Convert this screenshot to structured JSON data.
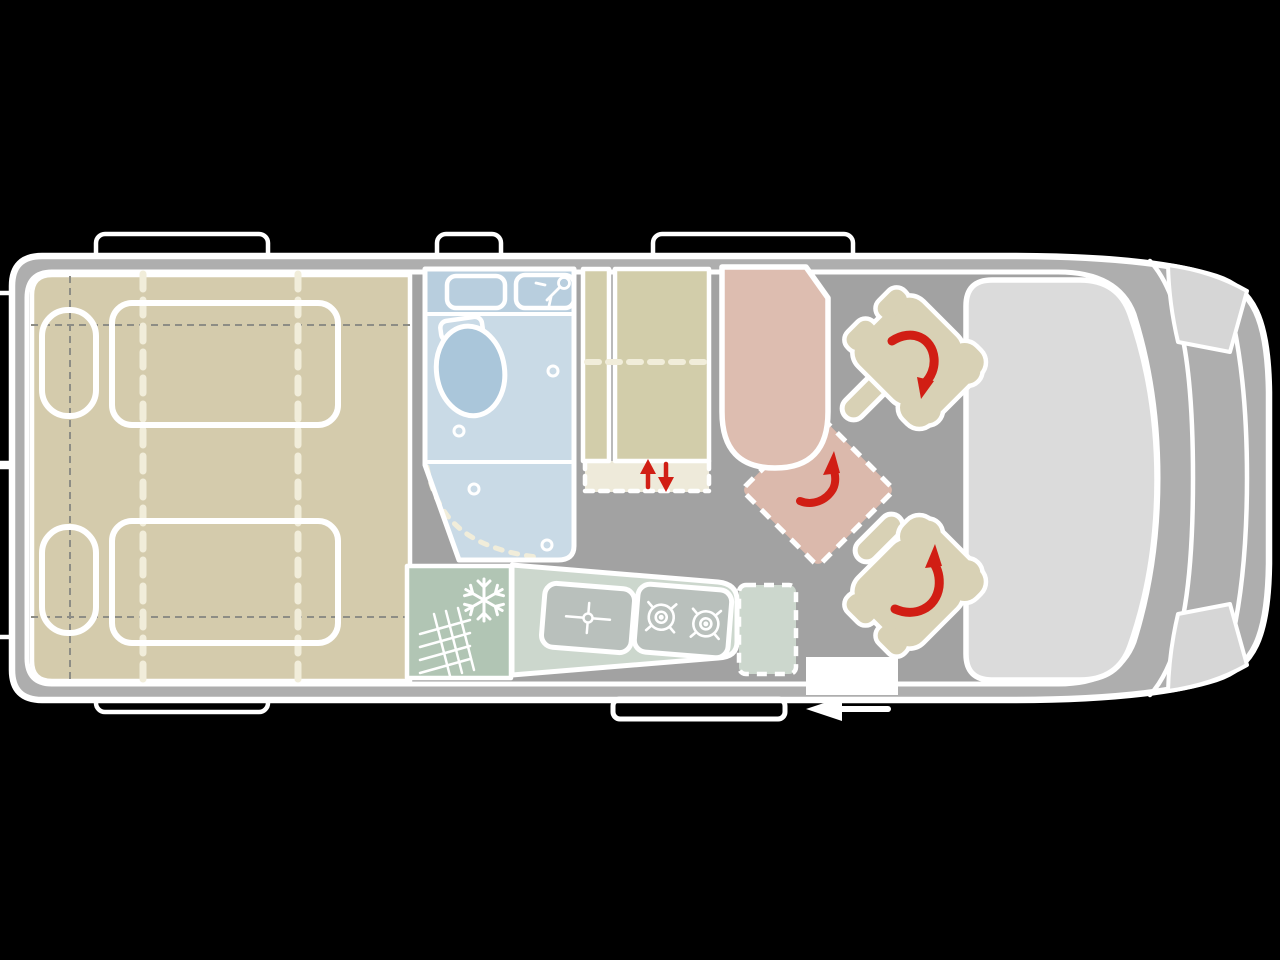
{
  "palette": {
    "bg": "#000000",
    "wall": "#aeaeae",
    "floor": "#a2a2a2",
    "line": "#ffffff",
    "bed": "#d4cbac",
    "wardrobe": "#d2cdaa",
    "seat": "#d8d1b5",
    "bench": "#ddbdb0",
    "bench-ghost": "#dbb9ac",
    "bath-light": "#c9dae6",
    "bath-dark": "#b8cede",
    "toilet": "#aac6da",
    "fridge": "#b1c5b4",
    "counter": "#ccd7cd",
    "appliance": "#b9c0bc",
    "windshield": "#dbdbdb",
    "headlight": "#d6d6d6",
    "cream": "#f1edda",
    "lift": "#eeeada",
    "red": "#d11e14",
    "dash-gray": "#8d8d85"
  },
  "diagram": {
    "type": "campervan-floorplan-top-view",
    "vehicle_front_side": "right",
    "zones": [
      {
        "id": "rear-bed",
        "name": "twin-beds-with-pillows",
        "color_key": "bed"
      },
      {
        "id": "bathroom",
        "name": "bathroom-toilet-washbasin-shower",
        "color_key": "bath-light"
      },
      {
        "id": "wardrobe",
        "name": "wardrobe-with-lift-mechanism",
        "color_key": "wardrobe"
      },
      {
        "id": "kitchen",
        "name": "kitchen-fridge-sink-two-burner-stove",
        "color_key": "counter"
      },
      {
        "id": "bench-seat",
        "name": "forward-bench-seat",
        "color_key": "bench"
      },
      {
        "id": "swivel-zone",
        "name": "dashed-swivel-position",
        "color_key": "bench-ghost"
      },
      {
        "id": "cab-seats",
        "name": "two-swivelling-cab-seats",
        "color_key": "seat"
      },
      {
        "id": "cab",
        "name": "driver-cab-windshield-hood-headlights",
        "color_key": "windshield"
      }
    ],
    "icons": [
      {
        "name": "snowflake-icon",
        "meaning": "refrigerator"
      },
      {
        "name": "heater-grate-icon",
        "meaning": "heater-vent"
      },
      {
        "name": "sink-faucet-icon",
        "meaning": "kitchen-sink"
      },
      {
        "name": "burner-icon",
        "count": 2,
        "meaning": "gas-hob"
      },
      {
        "name": "shower-head-icon",
        "meaning": "shower"
      },
      {
        "name": "rotation-arrow-icon",
        "count": 3,
        "meaning": "seat-swivels"
      },
      {
        "name": "lift-arrows-icon",
        "meaning": "raises-and-lowers"
      },
      {
        "name": "entry-arrow-icon",
        "meaning": "entrance-through-sliding-door"
      }
    ]
  }
}
